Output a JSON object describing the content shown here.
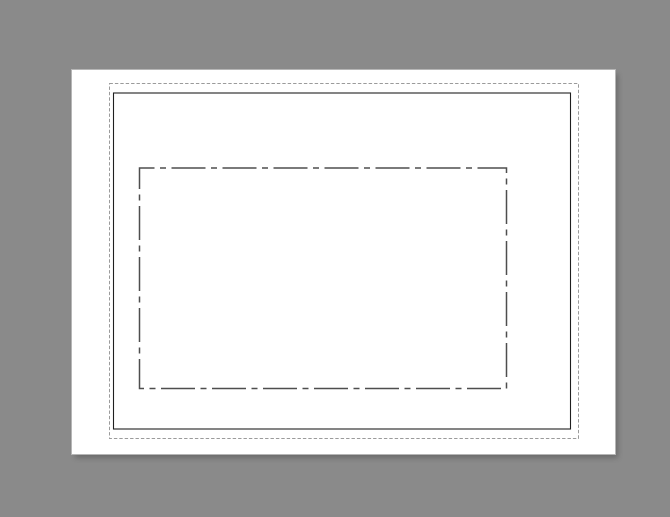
{
  "workspace": {
    "background_color": "#8a8a8a"
  },
  "page": {
    "background_color": "#ffffff",
    "edge_color": "#b6b6b6",
    "shadow_side": "bottom-right"
  },
  "overlays": {
    "margin_guide": {
      "line_style": "fine-dashed",
      "color": "#9b9b9b"
    },
    "page_frame": {
      "line_style": "solid",
      "color": "#1f1f1f"
    },
    "placeholder_outline": {
      "line_style": "dash-dot",
      "color": "#4e4e4e"
    }
  }
}
